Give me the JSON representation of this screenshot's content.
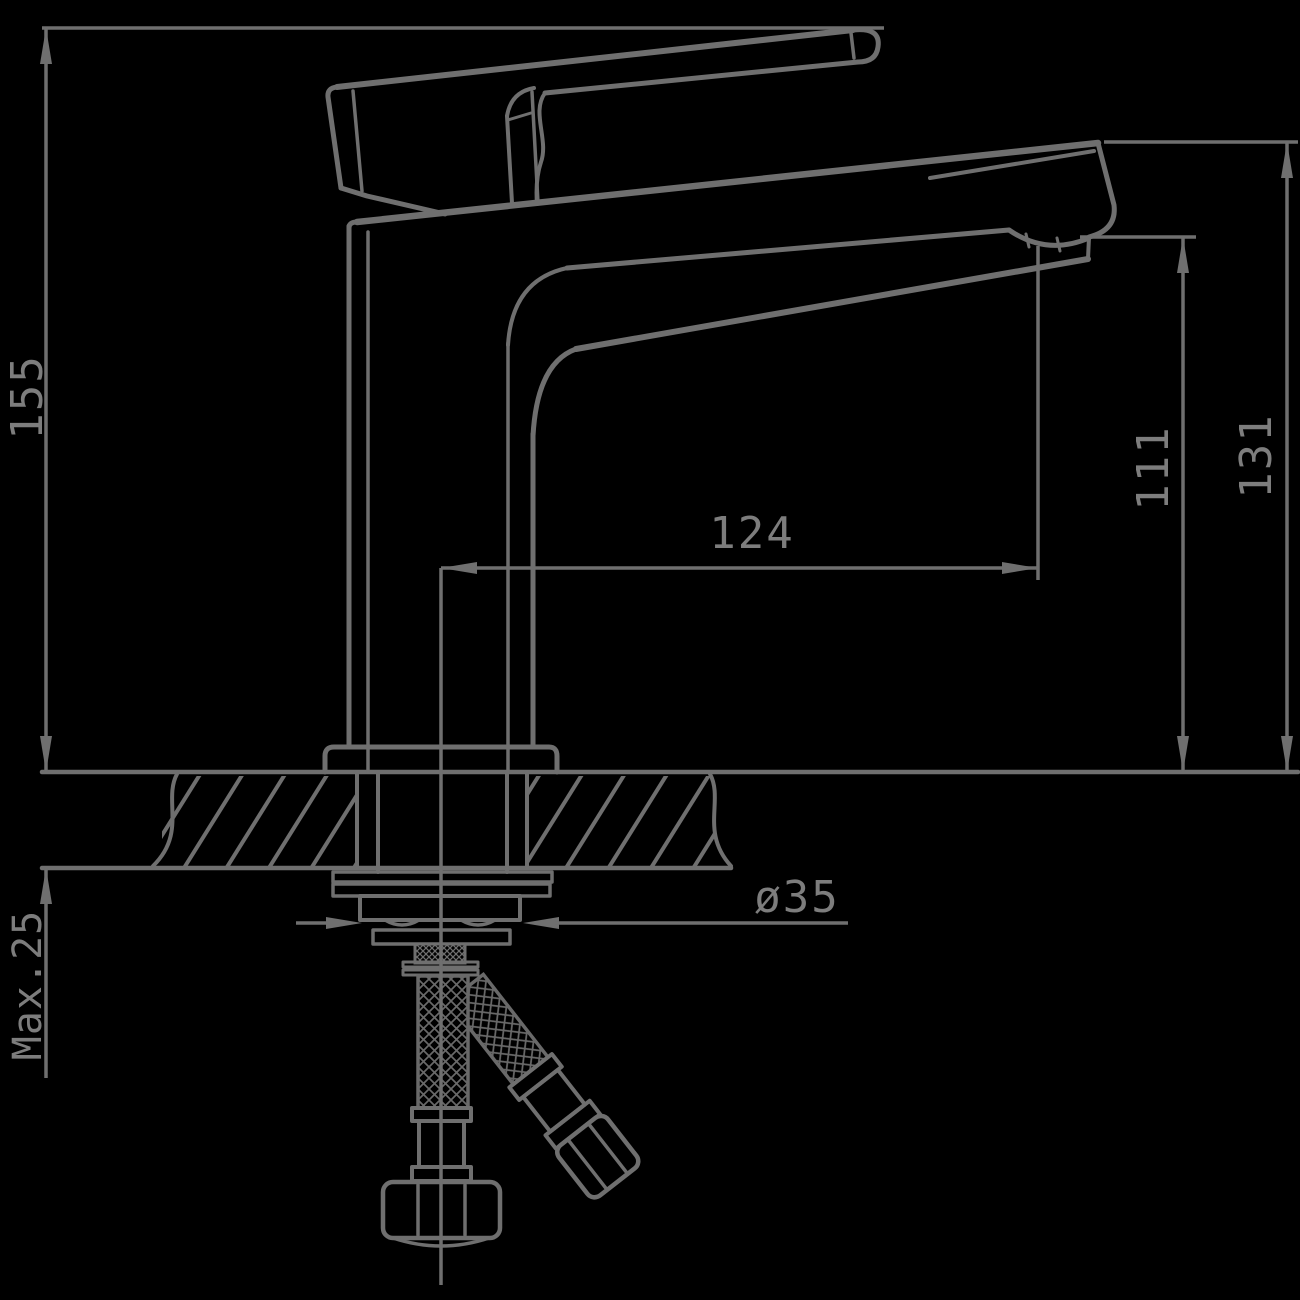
{
  "drawing": {
    "type": "faucet-installation-dimension-drawing",
    "dimensions": {
      "overall_height": "155",
      "spout_reach": "124",
      "aerator_to_deck": "111",
      "spout_top_to_deck": "131",
      "mounting_hole_diameter": "ø35",
      "max_deck_thickness": "Max.25"
    },
    "colors": {
      "background": "#000000",
      "line": "#6f6f6f",
      "text": "#7d7d7d"
    }
  }
}
